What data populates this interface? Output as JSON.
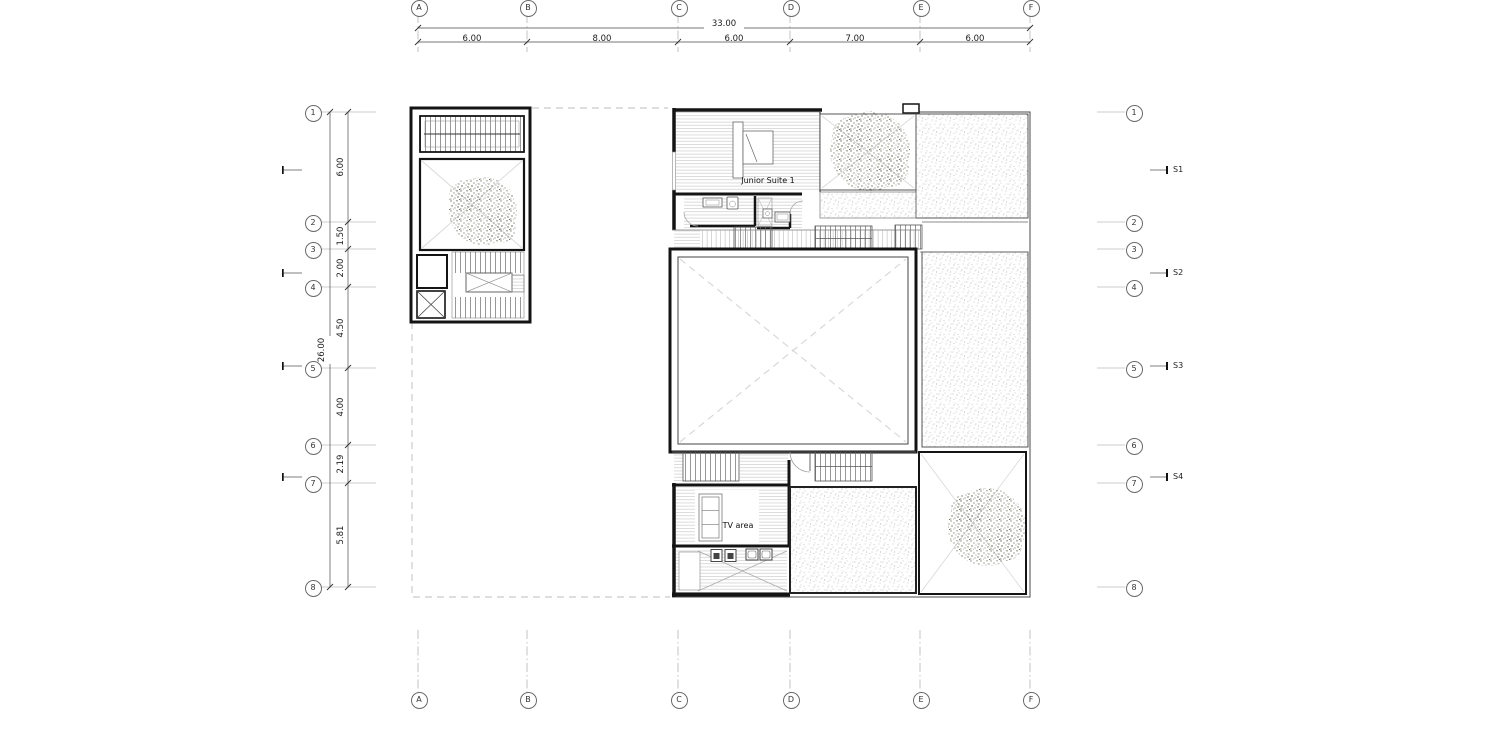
{
  "grid": {
    "columns": [
      {
        "label": "A"
      },
      {
        "label": "B"
      },
      {
        "label": "C"
      },
      {
        "label": "D"
      },
      {
        "label": "E"
      },
      {
        "label": "F"
      }
    ],
    "rows": [
      {
        "label": "1"
      },
      {
        "label": "2"
      },
      {
        "label": "3"
      },
      {
        "label": "4"
      },
      {
        "label": "5"
      },
      {
        "label": "6"
      },
      {
        "label": "7"
      },
      {
        "label": "8"
      }
    ],
    "top_dimensions": {
      "total": "33.00",
      "segments": [
        {
          "value": "6.00"
        },
        {
          "value": "8.00"
        },
        {
          "value": "6.00"
        },
        {
          "value": "7.00"
        },
        {
          "value": "6.00"
        }
      ]
    },
    "left_dimensions": {
      "total": "26.00",
      "segments": [
        {
          "value": "6.00"
        },
        {
          "value": "1.50"
        },
        {
          "value": "2.00"
        },
        {
          "value": "4.50"
        },
        {
          "value": "4.00"
        },
        {
          "value": "2.19"
        },
        {
          "value": "5.81"
        }
      ]
    }
  },
  "sections": [
    {
      "label": "S1"
    },
    {
      "label": "S2"
    },
    {
      "label": "S3"
    },
    {
      "label": "S4"
    }
  ],
  "rooms": {
    "junior_suite": {
      "label": "Junior Suite 1"
    },
    "tv_area": {
      "label": "TV area"
    }
  },
  "colors": {
    "wall": "#141414",
    "medium_line": "#555555",
    "light_line": "#999999",
    "hatch": "#b5b5b5",
    "diagonal": "#d8d8d8",
    "stipple": "#b0b0b0",
    "foliage": "#84897a"
  }
}
